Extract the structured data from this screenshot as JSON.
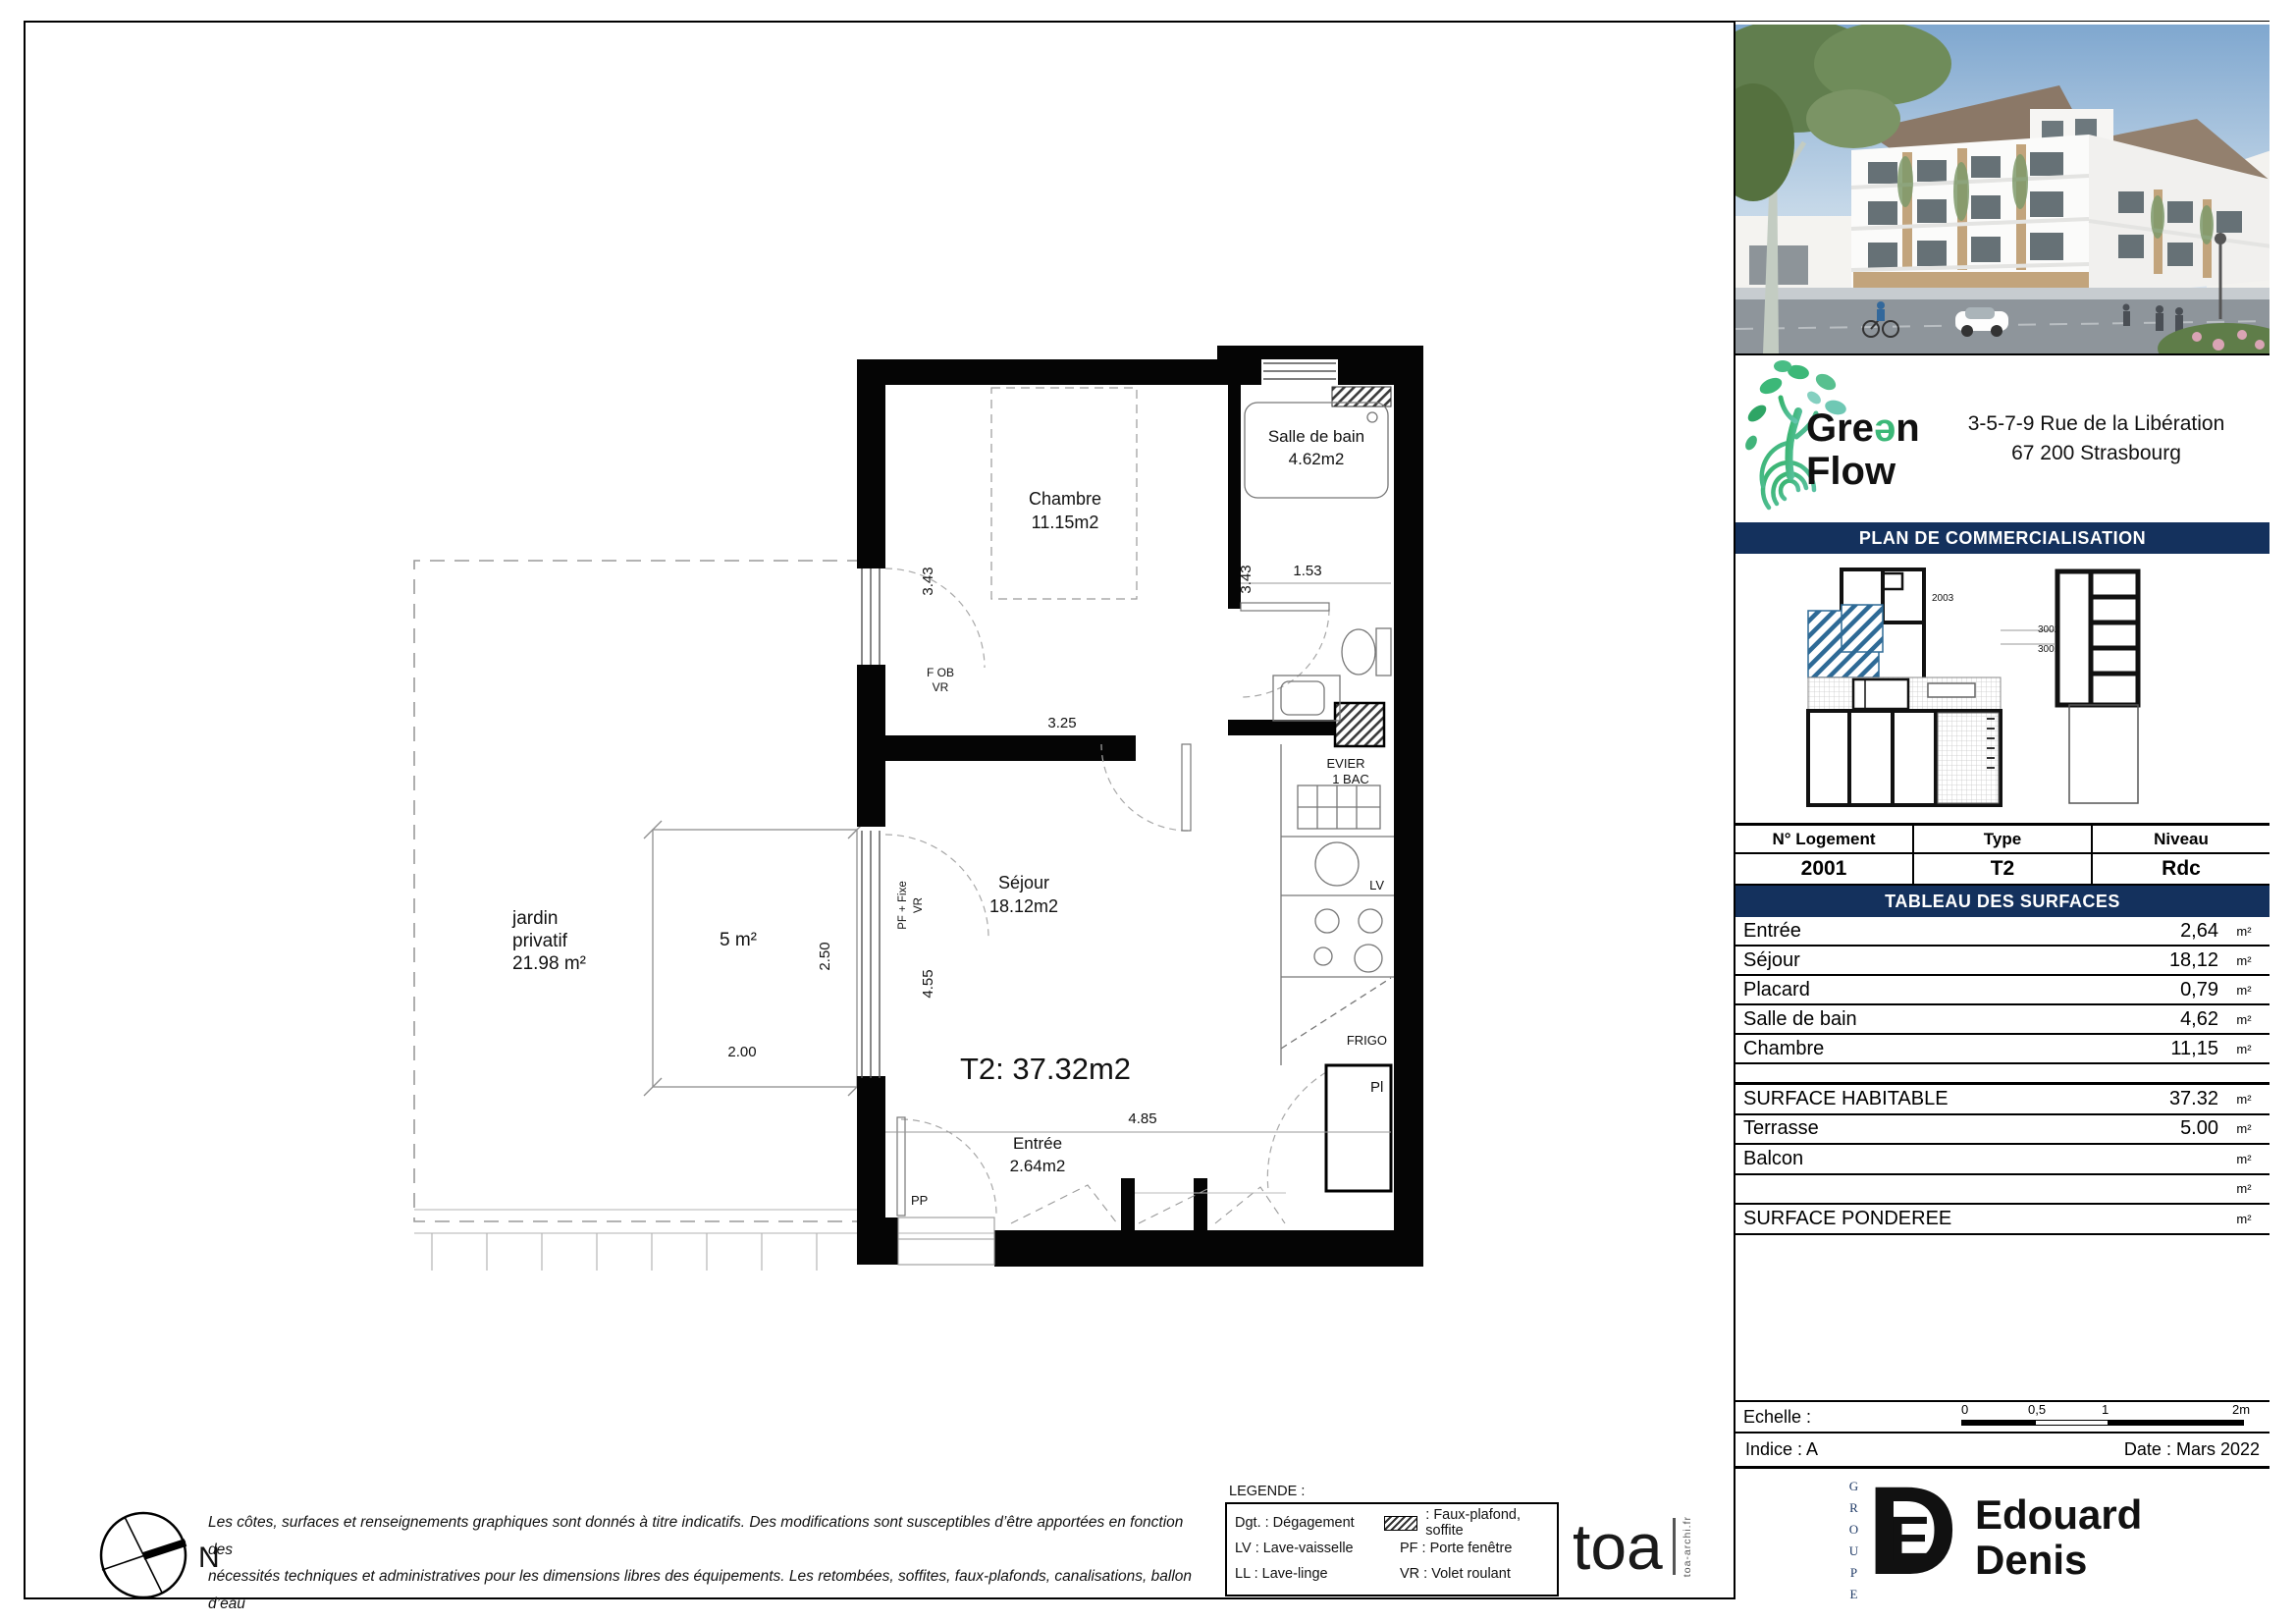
{
  "side_panel": {
    "brand": {
      "g1": "Gre",
      "g2": "ə",
      "g3": "n",
      "flow": "Flow"
    },
    "address_line1": "3-5-7-9 Rue de la Libération",
    "address_line2": "67 200 Strasbourg",
    "banner_plan": "PLAN DE COMMERCIALISATION",
    "siteplan_labels": {
      "a": "2003",
      "b": "3002",
      "c": "3001"
    },
    "logement": {
      "headers": [
        "N° Logement",
        "Type",
        "Niveau"
      ],
      "values": [
        "2001",
        "T2",
        "Rdc"
      ]
    },
    "banner_surfaces": "TABLEAU DES SURFACES",
    "surface_rows": [
      {
        "label": "Entrée",
        "value": "2,64",
        "unit": "m²"
      },
      {
        "label": "Séjour",
        "value": "18,12",
        "unit": "m²"
      },
      {
        "label": "Placard",
        "value": "0,79",
        "unit": "m²"
      },
      {
        "label": "Salle de bain",
        "value": "4,62",
        "unit": "m²"
      },
      {
        "label": "Chambre",
        "value": "11,15",
        "unit": "m²"
      }
    ],
    "totals_rows": [
      {
        "label": "SURFACE HABITABLE",
        "value": "37.32",
        "unit": "m²"
      },
      {
        "label": "Terrasse",
        "value": "5.00",
        "unit": "m²"
      },
      {
        "label": "Balcon",
        "value": "",
        "unit": "m²"
      },
      {
        "label": "",
        "value": "",
        "unit": "m²"
      },
      {
        "label": "SURFACE PONDEREE",
        "value": "",
        "unit": "m²"
      }
    ],
    "echelle_label": "Echelle :",
    "scale_ticks": [
      "0",
      "0,5",
      "1",
      "2m"
    ],
    "indice": "Indice : A",
    "date": "Date : Mars 2022",
    "groupe": "GROUPE",
    "ed_logo": {
      "d": "D",
      "e": "E"
    },
    "brand2_line1": "Edouard",
    "brand2_line2": "Denis"
  },
  "plan": {
    "unit_label": "T2: 37.32m2",
    "rooms": {
      "chambre": {
        "name": "Chambre",
        "area": "11.15m2"
      },
      "sdb": {
        "name": "Salle de bain",
        "area": "4.62m2"
      },
      "sejour": {
        "name": "Séjour",
        "area": "18.12m2"
      },
      "entree": {
        "name": "Entrée",
        "area": "2.64m2"
      }
    },
    "jardin": {
      "line1": "jardin",
      "line2": "privatif",
      "line3": "21.98 m²"
    },
    "terrasse_area": "5 m²",
    "dims": {
      "d343a": "3.43",
      "d343b": "3.43",
      "d153": "1.53",
      "d325": "3.25",
      "d455": "4.55",
      "d485": "4.85",
      "d250": "2.50",
      "d200": "2.00"
    },
    "window_labels": {
      "fob": "F OB",
      "fob_vr": "VR",
      "pf": "PF + Fixe",
      "pf_vr": "VR",
      "pp": "PP"
    },
    "kitchen": {
      "evier1": "EVIER",
      "evier2": "1 BAC",
      "lv": "LV",
      "frigo": "FRIGO",
      "pl": "Pl"
    },
    "compass": "N"
  },
  "legend": {
    "title": "LEGENDE :",
    "row1_left": "Dgt. : Dégagement",
    "row1_right": ": Faux-plafond, soffite",
    "row2_left": "LV : Lave-vaisselle",
    "row2_right": "PF : Porte fenêtre",
    "row3_left": "LL : Lave-linge",
    "row3_right": "VR : Volet roulant"
  },
  "disclaimer": {
    "line1": "Les côtes, surfaces et renseignements graphiques sont donnés à titre indicatifs. Des modifications sont susceptibles d’être apportées en fonction des",
    "line2": "nécessités techniques et administratives pour les dimensions libres des équipements. Les retombées, soffites, faux-plafonds, canalisations, ballon d’eau",
    "line3": "chaude, sont mentionnés à titre indicatif. Le mobilier est indicatif et notament l’emplacement des équipements sanitaires et leurs aménagements."
  },
  "footer": {
    "toa": "toa",
    "toa_sub": "toa-archi.fr"
  }
}
